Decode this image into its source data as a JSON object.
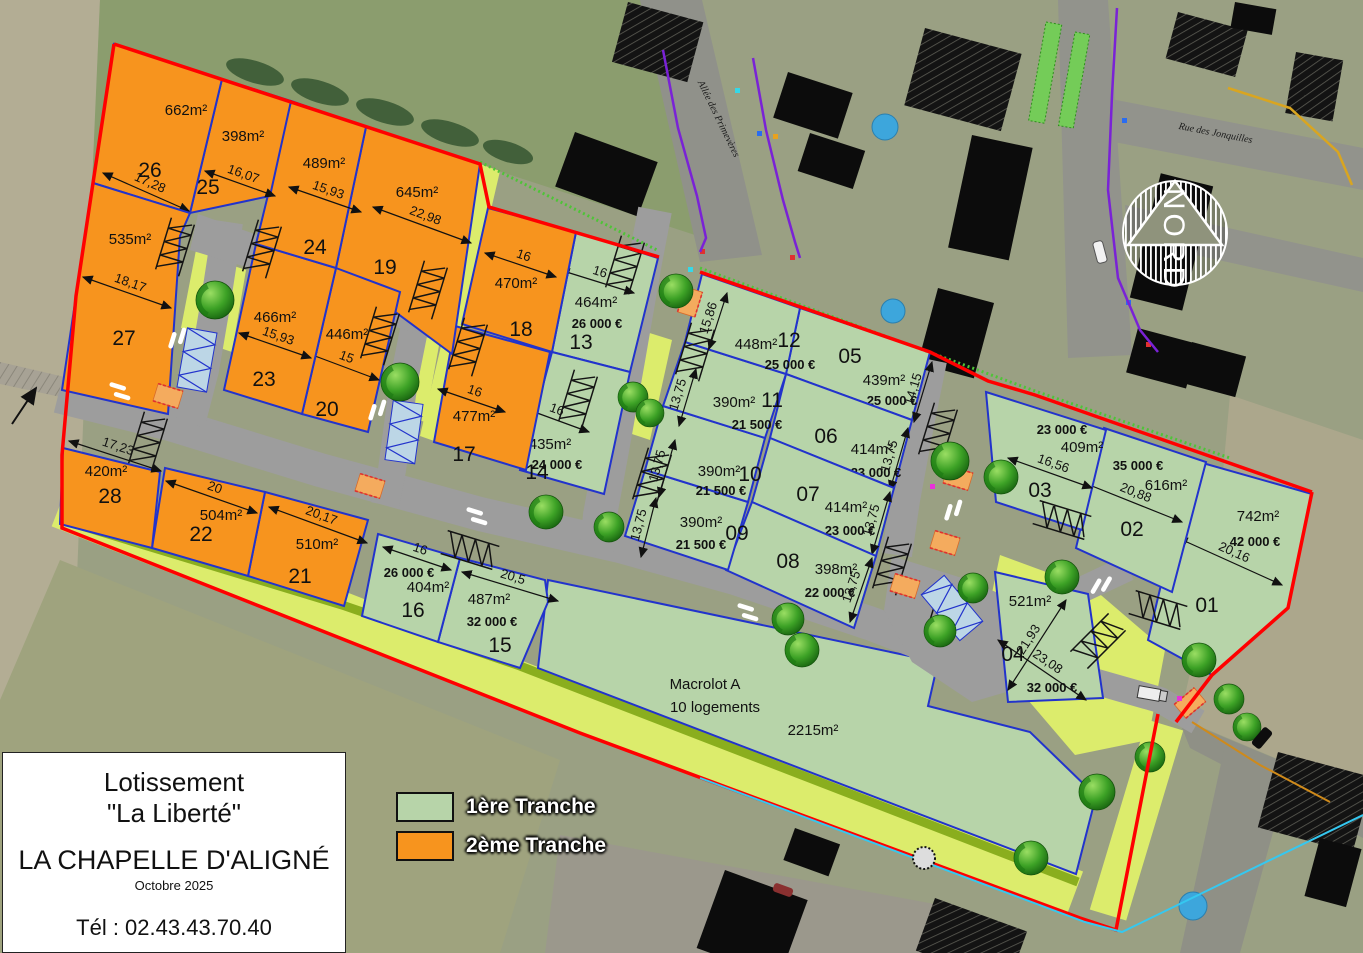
{
  "title_block": {
    "line1": "Lotissement",
    "line2": "\"La Liberté\"",
    "city": "LA CHAPELLE D'ALIGNÉ",
    "date": "Octobre 2025",
    "phone": "Tél : 02.43.43.70.40"
  },
  "legend": {
    "tranche1": {
      "label": "1ère Tranche",
      "color": "#b7d4a9"
    },
    "tranche2": {
      "label": "2ème Tranche",
      "color": "#f7941e"
    }
  },
  "map": {
    "compass_label": "NORD",
    "street_allee": "Allée des Primevères",
    "street_rue": "Rue des Jonquilles",
    "macrolot": {
      "title": "Macrolot A",
      "subtitle": "10 logements",
      "area": "2215m²"
    }
  },
  "colors": {
    "boundary_red": "#ff0000",
    "lot_border_blue": "#2233cc",
    "road_gray": "#9d9d9d",
    "green_band": "#dcec6c",
    "olive_band": "#8aae1e"
  },
  "lots": [
    {
      "num": "01",
      "area": "742m²",
      "price": "42 000 €",
      "dims": [
        "20,16"
      ],
      "tranche": 1
    },
    {
      "num": "02",
      "area": "616m²",
      "price": "35 000 €",
      "dims": [
        "20,88"
      ],
      "tranche": 1
    },
    {
      "num": "03",
      "area": "409m²",
      "price": "23 000 €",
      "dims": [
        "16,56"
      ],
      "tranche": 1
    },
    {
      "num": "04",
      "area": "521m²",
      "price": "32 000 €",
      "dims": [
        "21,93",
        "23,08"
      ],
      "tranche": 1
    },
    {
      "num": "05",
      "area": "439m²",
      "price": "25 000 €",
      "dims": [
        "14,15"
      ],
      "tranche": 1
    },
    {
      "num": "06",
      "area": "414m²",
      "price": "23 000 €",
      "dims": [
        "13,75"
      ],
      "tranche": 1
    },
    {
      "num": "07",
      "area": "414m²",
      "price": "23 000 €",
      "dims": [
        "13,75"
      ],
      "tranche": 1
    },
    {
      "num": "08",
      "area": "398m²",
      "price": "22 000 €",
      "dims": [
        "13,75"
      ],
      "tranche": 1
    },
    {
      "num": "09",
      "area": "390m²",
      "price": "21 500 €",
      "dims": [
        "13,75"
      ],
      "tranche": 1
    },
    {
      "num": "10",
      "area": "390m²",
      "price": "21 500 €",
      "dims": [
        "13,75"
      ],
      "tranche": 1
    },
    {
      "num": "11",
      "area": "390m²",
      "price": "21 500 €",
      "dims": [
        "13,75"
      ],
      "tranche": 1
    },
    {
      "num": "12",
      "area": "448m²",
      "price": "25 000 €",
      "dims": [
        "15,86"
      ],
      "tranche": 1
    },
    {
      "num": "13",
      "area": "464m²",
      "price": "26 000 €",
      "dims": [
        "16"
      ],
      "tranche": 1
    },
    {
      "num": "14",
      "area": "435m²",
      "price": "24 000 €",
      "dims": [
        "16"
      ],
      "tranche": 1
    },
    {
      "num": "15",
      "area": "487m²",
      "price": "32 000 €",
      "dims": [
        "20,5"
      ],
      "tranche": 1
    },
    {
      "num": "16",
      "area": "404m²",
      "price": "26 000 €",
      "dims": [
        "16"
      ],
      "tranche": 1
    },
    {
      "num": "17",
      "area": "477m²",
      "price": null,
      "dims": [
        "16"
      ],
      "tranche": 2
    },
    {
      "num": "18",
      "area": "470m²",
      "price": null,
      "dims": [
        "16"
      ],
      "tranche": 2
    },
    {
      "num": "19",
      "area": "645m²",
      "price": null,
      "dims": [
        "22,98"
      ],
      "tranche": 2
    },
    {
      "num": "20",
      "area": "446m²",
      "price": null,
      "dims": [
        "15"
      ],
      "tranche": 2
    },
    {
      "num": "21",
      "area": "510m²",
      "price": null,
      "dims": [
        "20,17"
      ],
      "tranche": 2
    },
    {
      "num": "22",
      "area": "504m²",
      "price": null,
      "dims": [
        "20"
      ],
      "tranche": 2
    },
    {
      "num": "23",
      "area": "466m²",
      "price": null,
      "dims": [
        "15,93"
      ],
      "tranche": 2
    },
    {
      "num": "24",
      "area": "489m²",
      "price": null,
      "dims": [
        "15,93"
      ],
      "tranche": 2
    },
    {
      "num": "25",
      "area": "398m²",
      "price": null,
      "dims": [
        "16,07"
      ],
      "tranche": 2
    },
    {
      "num": "26",
      "area": "662m²",
      "price": null,
      "dims": [
        "17,28"
      ],
      "tranche": 2
    },
    {
      "num": "27",
      "area": "535m²",
      "price": null,
      "dims": [
        "18,17"
      ],
      "tranche": 2
    },
    {
      "num": "28",
      "area": "420m²",
      "price": null,
      "dims": [
        "17,23"
      ],
      "tranche": 2
    }
  ]
}
